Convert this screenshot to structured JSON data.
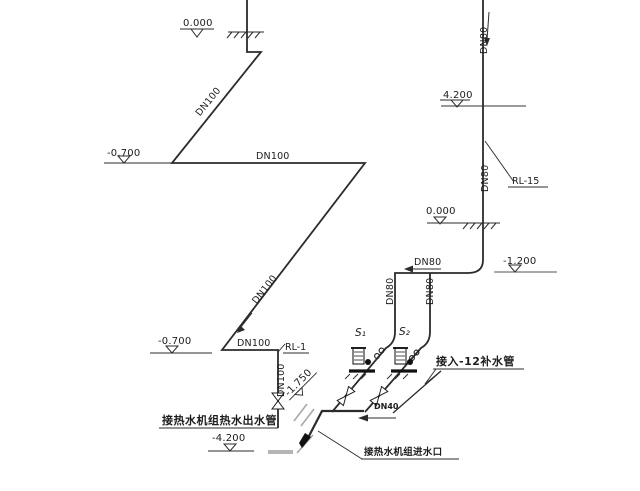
{
  "diagram": {
    "kind": "hot-water-unit piping axonometric drawing",
    "colors": {
      "line": "#2b2b2b",
      "gray": "#9a9a9a",
      "text": "#1c1c1c"
    },
    "elevations": {
      "top_left_ground": "0.000",
      "left_upper": "-0.700",
      "left_lower": "-0.700",
      "bottom_floor": "-4.200",
      "right_upper": "4.200",
      "right_ground": "0.000",
      "right_lower": "-1.200",
      "rotated_marker": "-1.750"
    },
    "pipe_labels": {
      "main_diag_upper": "DN100",
      "main_horiz_upper": "DN100",
      "main_diag_long": "DN100",
      "main_horiz_lower": "DN100",
      "main_vert_lower": "DN100",
      "right_riser_upper": "DN80",
      "right_riser_mid": "DN80",
      "pump_header": "DN80",
      "pump_drop_left": "DN80",
      "pump_drop_right": "DN80",
      "makeup_branch": "DN40"
    },
    "riser_tags": {
      "left": "RL-1",
      "right": "RL-15"
    },
    "pump_tags": {
      "left": "S₁",
      "right": "S₂"
    },
    "notes": {
      "outlet_pipe": "接热水机组热水出水管",
      "inlet_port": "接热水机组进水口",
      "makeup_source": "接入-12补水管"
    }
  }
}
